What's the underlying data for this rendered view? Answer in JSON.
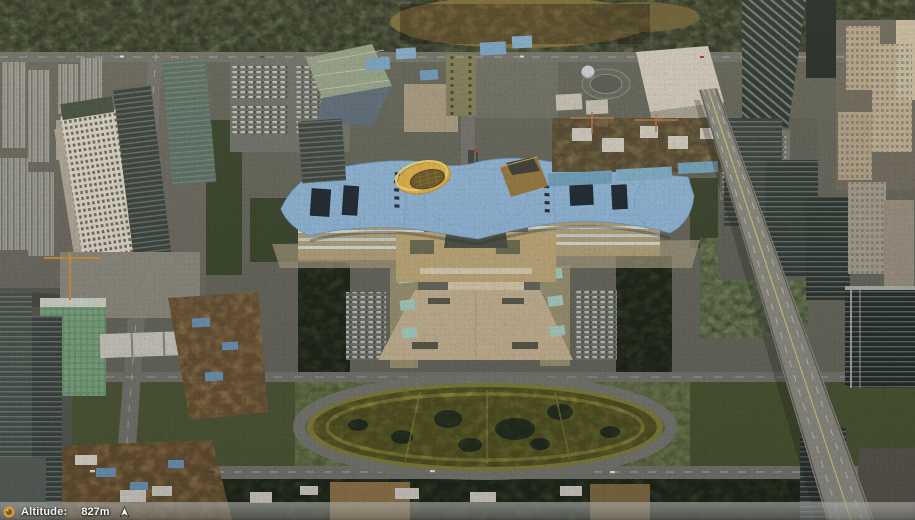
{
  "hud": {
    "altitude_label": "Altitude:",
    "altitude_value": "827m"
  },
  "icons": {
    "status": "globe-icon",
    "compass": "north-arrow-icon"
  },
  "colors": {
    "hud_icon_orange": "#dd9a2e",
    "hud_text": "#f4f4ef",
    "civic_roof_blue": "#8fb7d9",
    "cylinder_yellow": "#e2b44a",
    "pyramid_brown": "#97793f",
    "plaza_tan": "#c3b291",
    "lawn_olive": "#70702e",
    "tree_green": "#38452b",
    "road_gray": "#73736c",
    "highway_gray": "#8b8b81"
  }
}
